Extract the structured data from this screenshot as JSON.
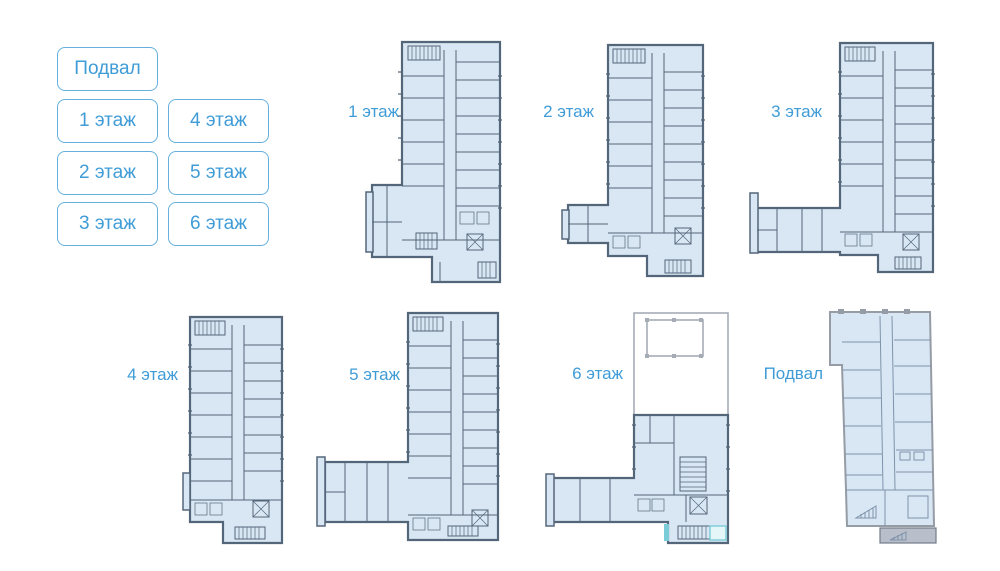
{
  "colors": {
    "accent_blue": "#3f9cd7",
    "button_border": "#65b0de",
    "plan_fill": "#d9e7f4",
    "plan_wall": "#54667a",
    "basement_wall": "#959ca6",
    "basement_interior": "#7e93ab",
    "roof_outline": "#a6acb5",
    "teal_accent": "#79ccd8",
    "basement_block": "#b9bfca",
    "background": "#ffffff"
  },
  "floor_buttons": [
    {
      "label": "Подвал"
    },
    {
      "label": "1 этаж"
    },
    {
      "label": "4 этаж"
    },
    {
      "label": "2 этаж"
    },
    {
      "label": "5 этаж"
    },
    {
      "label": "3 этаж"
    },
    {
      "label": "6 этаж"
    }
  ],
  "plans": [
    {
      "label": "1 этаж"
    },
    {
      "label": "2 этаж"
    },
    {
      "label": "3 этаж"
    },
    {
      "label": "4 этаж"
    },
    {
      "label": "5 этаж"
    },
    {
      "label": "6 этаж"
    },
    {
      "label": "Подвал"
    }
  ]
}
